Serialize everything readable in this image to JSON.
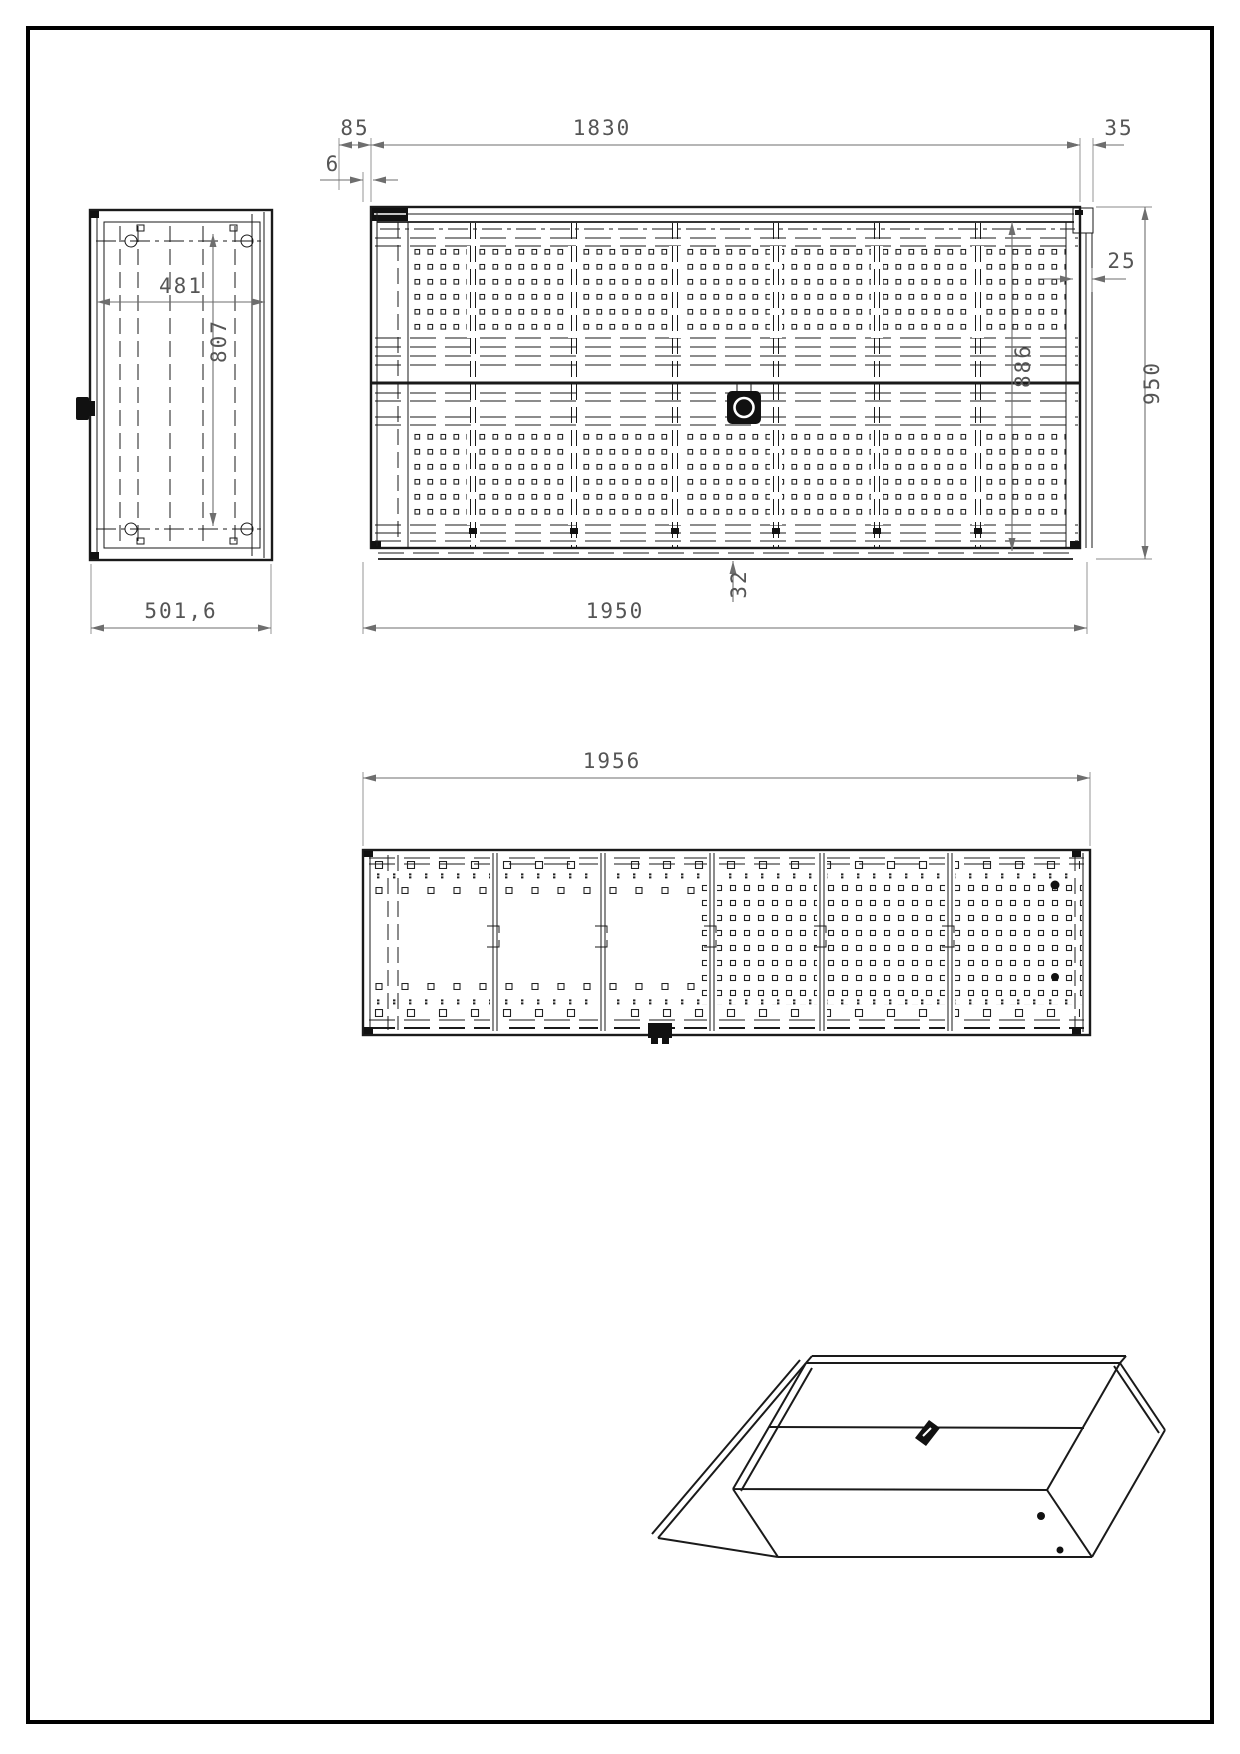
{
  "sheet": {
    "type": "technical-drawing",
    "background": "#ffffff",
    "frame_color": "#000000"
  },
  "colors": {
    "geometry": "#1a1a1a",
    "dimension_line": "#6e6e6e",
    "dimension_text": "#555555"
  },
  "dims": {
    "front_top_left": "85",
    "front_gap": "6",
    "front_panel": "1830",
    "front_top_right": "35",
    "front_edge": "25",
    "front_inner_height": "886",
    "front_height": "950",
    "front_width": "1950",
    "front_bottom_rail": "32",
    "side_inner_width": "481",
    "side_inner_height": "807",
    "side_depth": "501,6",
    "top_width": "1956"
  }
}
